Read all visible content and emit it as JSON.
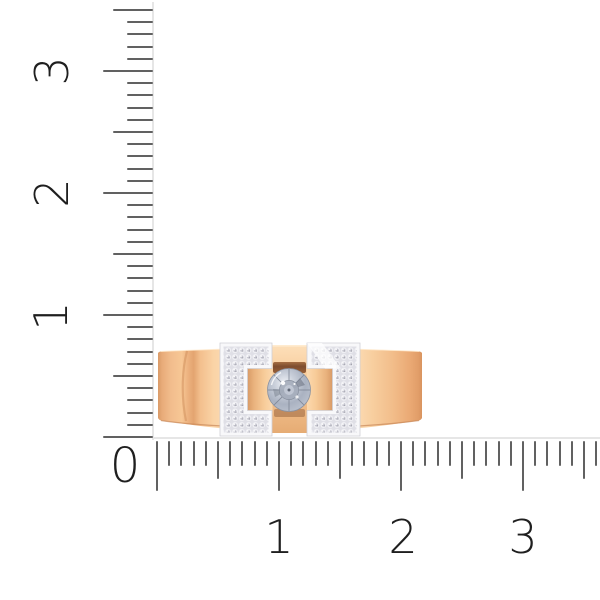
{
  "canvas": {
    "width": 600,
    "height": 600,
    "background": "#ffffff"
  },
  "ruler": {
    "origin_label": "0",
    "unit_px": 122,
    "minor_per_unit": 10,
    "tick_color": "#616161",
    "label_color": "#1f1f1f",
    "spine_color": "#e6e6e6",
    "vertical": {
      "range_units": 3.5,
      "zero_y": 437,
      "edge_x": 153,
      "labels": [
        {
          "text": "3",
          "value": 3
        },
        {
          "text": "2",
          "value": 2
        },
        {
          "text": "1",
          "value": 1
        }
      ]
    },
    "horizontal": {
      "range_units": 3.6,
      "zero_x": 157,
      "edge_y": 441,
      "labels": [
        {
          "text": "1",
          "value": 1
        },
        {
          "text": "2",
          "value": 2
        },
        {
          "text": "3",
          "value": 3
        }
      ]
    }
  },
  "product": {
    "kind": "ring-photo",
    "colors": {
      "rose_gold": "#f6c897",
      "rose_gold_highlight": "#fcdcb5",
      "rose_gold_shadow": "#d99a67",
      "white_gold": "#f8f8fa",
      "pave_field": "#dfdfe6",
      "center_stone": "#b3bac7",
      "stone_facet": "#7a8291"
    }
  }
}
